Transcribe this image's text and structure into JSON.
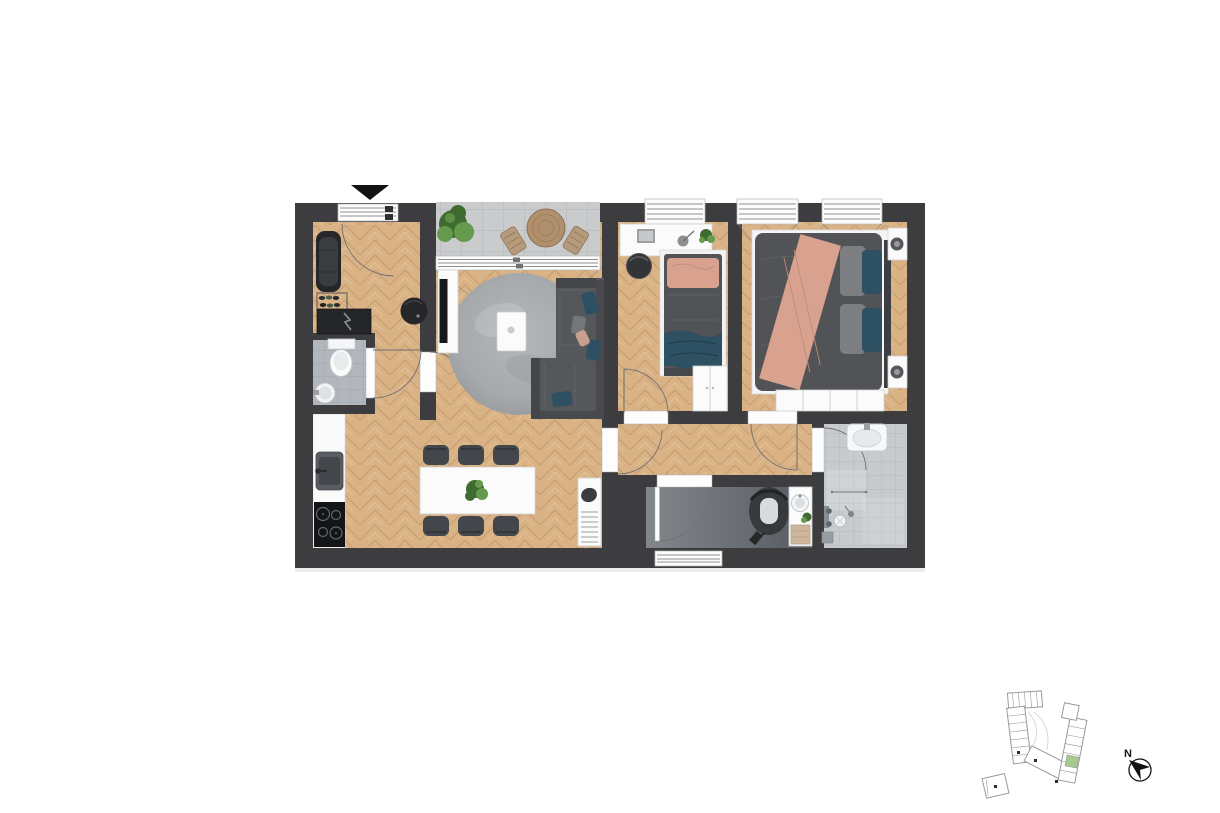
{
  "canvas": {
    "width": 1220,
    "height": 813,
    "background": "#ffffff"
  },
  "compass": {
    "label": "N",
    "icon": "north-arrow-icon",
    "needle_points": "north-west"
  },
  "entrance": {
    "icon": "entrance-triangle-icon"
  },
  "colors": {
    "wall": "#3d3d3f",
    "wood": "#d9b286",
    "wood_dark": "#c49a6b",
    "wood_light": "#e7c698",
    "tile_wc": "#b2b7bd",
    "tile_wc_line": "#a4a9af",
    "tile_bath": "#c7cbce",
    "tile_bath_line": "#b9bdc1",
    "tile_balcony": "#c9cbcc",
    "tile_balcony_line": "#b9bcbd",
    "white_furniture": "#fbfbfb",
    "dark_furniture": "#242628",
    "sofa": "#55575b",
    "bed": "#515356",
    "teal": "#2d5063",
    "salmon": "#d8a28f",
    "rug": "#a7aaad",
    "chair": "#43464a",
    "plant_dark": "#3f6b31",
    "plant_light": "#649a4b",
    "outline": "#8f9193",
    "keyplan_green": "#a6c98e",
    "marker": "#111214"
  },
  "floor_plan": {
    "rooms": [
      {
        "name": "entrance-hall",
        "floor": "wood-herringbone",
        "items": [
          "wardrobe-bench",
          "shoe-rack",
          "shoes",
          "electrical-cabinet",
          "pouf",
          "entrance-door"
        ]
      },
      {
        "name": "wc",
        "floor": "grey-tile",
        "items": [
          "toilet",
          "round-washbasin"
        ]
      },
      {
        "name": "kitchen",
        "floor": "wood-herringbone",
        "items": [
          "counter",
          "kitchen-sink",
          "cooktop"
        ]
      },
      {
        "name": "dining-area",
        "floor": "wood-herringbone",
        "items": [
          "dining-table",
          "dining-chairs-x6",
          "table-plant",
          "slatted-cabinet"
        ]
      },
      {
        "name": "living-room",
        "floor": "wood-herringbone",
        "items": [
          "tv-sideboard",
          "tv",
          "round-rug",
          "coffee-table",
          "corner-sofa",
          "cushions"
        ]
      },
      {
        "name": "balcony",
        "floor": "concrete-tile",
        "items": [
          "shrub",
          "bistro-table",
          "outdoor-chairs-x2",
          "sliding-door"
        ]
      },
      {
        "name": "small-bedroom",
        "floor": "wood-herringbone",
        "items": [
          "desk",
          "laptop",
          "desk-lamp",
          "desk-plant",
          "stool",
          "single-bed",
          "pillow",
          "blanket",
          "wardrobe",
          "window"
        ]
      },
      {
        "name": "master-bedroom",
        "floor": "wood-herringbone",
        "items": [
          "double-bed",
          "throw-blanket",
          "pillows-x4",
          "nightstand-x2",
          "table-lamp-x2",
          "wardrobe",
          "windows-x2"
        ]
      },
      {
        "name": "hallway",
        "floor": "wood-herringbone",
        "items": [
          "door-swings"
        ]
      },
      {
        "name": "utility-room",
        "floor": "screed",
        "items": [
          "stroller",
          "washbasin-cabinet",
          "plant",
          "storage-box",
          "window"
        ]
      },
      {
        "name": "bathroom",
        "floor": "grey-tile",
        "items": [
          "washbasin",
          "shower-mixer",
          "hand-shower",
          "floor-drain",
          "towel-rail",
          "bath-mat"
        ]
      }
    ],
    "window_count": 5,
    "door_swing_count": 8
  },
  "key_plan": {
    "buildings": [
      "main-complex",
      "annex"
    ],
    "highlighted_unit": true,
    "stair_dots": 4
  }
}
